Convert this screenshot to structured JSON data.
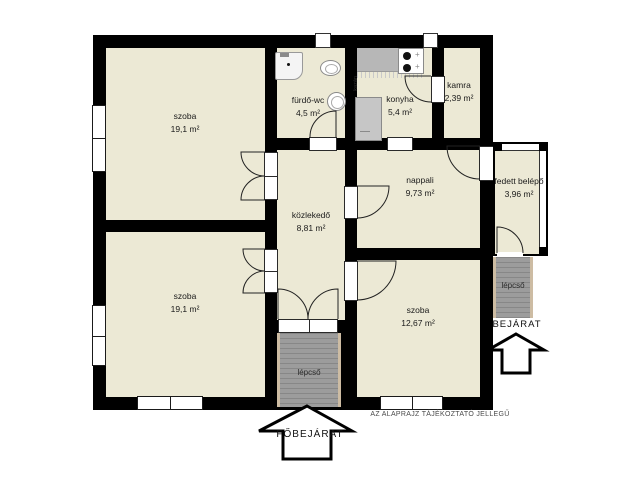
{
  "colors": {
    "room_fill": "#ECE9D5",
    "wall": "#000000",
    "stairs": "#9C9C9C",
    "stairs_border": "#CDBCA3",
    "counter": "#B7B7B7",
    "boiler": "#C6C6C6"
  },
  "rooms": [
    {
      "name": "szoba",
      "area": "19,1 m²"
    },
    {
      "name": "fürdő-wc",
      "area": "4,5 m²"
    },
    {
      "name": "konyha",
      "area": "5,4 m²"
    },
    {
      "name": "kamra",
      "area": "2,39 m²"
    },
    {
      "name": "nappali",
      "area": "9,73 m²"
    },
    {
      "name": "közlekedő",
      "area": "8,81 m²"
    },
    {
      "name": "szoba",
      "area": "19,1 m²"
    },
    {
      "name": "szoba",
      "area": "12,67 m²"
    },
    {
      "name": "fedett belépő",
      "area": "3,96 m²"
    }
  ],
  "labels": {
    "stairs_bottom": "lépcső",
    "stairs_right": "lépcső",
    "main_entrance": "FŐBEJÁRAT",
    "entrance": "BEJÁRAT",
    "boiler": "kazán",
    "disclaimer": "AZ ALAPRAJZ TÁJÉKOZTATÓ JELLEGŰ"
  }
}
